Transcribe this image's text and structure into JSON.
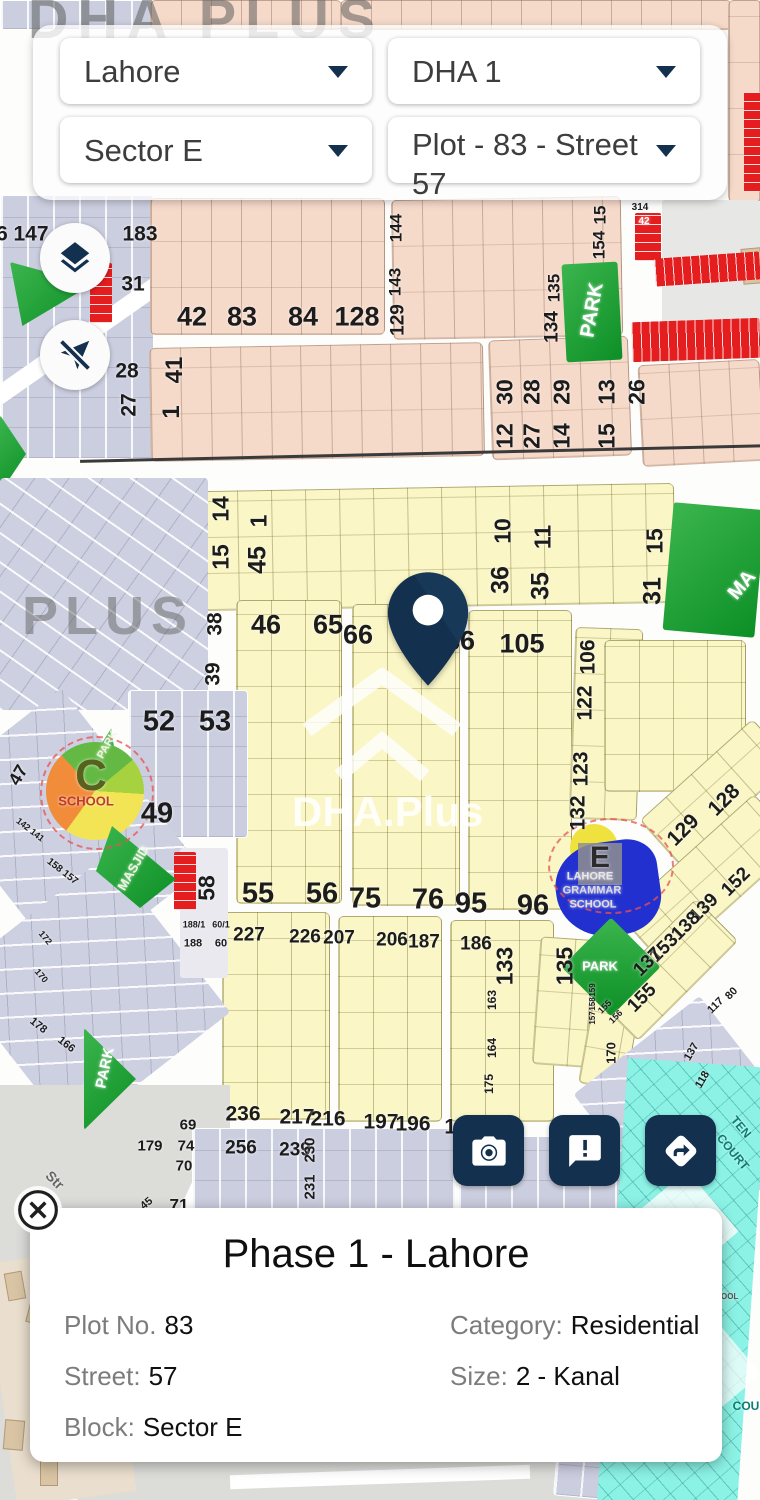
{
  "header": {
    "city": "Lahore",
    "phase": "DHA 1",
    "sector": "Sector E",
    "plot": "Plot - 83 - Street 57"
  },
  "icons": {
    "layers": "layers-icon",
    "location": "location-disabled-icon",
    "camera": "camera-icon",
    "feedback": "feedback-icon",
    "directions": "directions-icon",
    "close": "close-icon",
    "pin": "map-pin-icon"
  },
  "watermarks": {
    "top": "DHA PLUS",
    "left": "PLUS",
    "center": "DHA.Plus"
  },
  "info_card": {
    "title": "Phase 1 - Lahore",
    "fields": [
      {
        "label": "Plot No.",
        "value": "83"
      },
      {
        "label": "Category:",
        "value": "Residential"
      },
      {
        "label": "Street:",
        "value": "57"
      },
      {
        "label": "Size:",
        "value": "2 - Kanal"
      },
      {
        "label": "Block:",
        "value": "Sector E"
      }
    ]
  },
  "map": {
    "labels": [
      {
        "t": "6",
        "x": 2,
        "y": 234,
        "s": 21
      },
      {
        "t": "147",
        "x": 31,
        "y": 234,
        "s": 21
      },
      {
        "t": "183",
        "x": 140,
        "y": 234,
        "s": 21
      },
      {
        "t": "31",
        "x": 133,
        "y": 284,
        "s": 21
      },
      {
        "t": "28",
        "x": 127,
        "y": 371,
        "s": 21
      },
      {
        "t": "27",
        "x": 129,
        "y": 405,
        "s": 21,
        "r": -90
      },
      {
        "t": "42",
        "x": 192,
        "y": 317,
        "s": 27
      },
      {
        "t": "83",
        "x": 242,
        "y": 317,
        "s": 27
      },
      {
        "t": "84",
        "x": 303,
        "y": 317,
        "s": 27
      },
      {
        "t": "128",
        "x": 357,
        "y": 317,
        "s": 27
      },
      {
        "t": "41",
        "x": 175,
        "y": 370,
        "s": 24,
        "r": -90
      },
      {
        "t": "1",
        "x": 172,
        "y": 412,
        "s": 24,
        "r": -90
      },
      {
        "t": "144",
        "x": 396,
        "y": 228,
        "s": 17,
        "r": -90
      },
      {
        "t": "143",
        "x": 395,
        "y": 282,
        "s": 17,
        "r": -90
      },
      {
        "t": "129",
        "x": 398,
        "y": 320,
        "s": 19,
        "r": -90
      },
      {
        "t": "15",
        "x": 600,
        "y": 215,
        "s": 17,
        "r": -90
      },
      {
        "t": "154",
        "x": 599,
        "y": 245,
        "s": 17,
        "r": -90
      },
      {
        "t": "135",
        "x": 554,
        "y": 288,
        "s": 17,
        "r": -90
      },
      {
        "t": "134",
        "x": 552,
        "y": 327,
        "s": 19,
        "r": -90
      },
      {
        "t": "PARK",
        "x": 592,
        "y": 310,
        "s": 20,
        "r": -80,
        "c": "#ffffff"
      },
      {
        "t": "314",
        "x": 640,
        "y": 208,
        "s": 10
      },
      {
        "t": "42",
        "x": 644,
        "y": 222,
        "s": 10,
        "c": "#ffffff"
      },
      {
        "t": "30",
        "x": 505,
        "y": 392,
        "s": 23,
        "r": -90
      },
      {
        "t": "12",
        "x": 505,
        "y": 436,
        "s": 23,
        "r": -90
      },
      {
        "t": "28",
        "x": 532,
        "y": 392,
        "s": 23,
        "r": -90
      },
      {
        "t": "27",
        "x": 532,
        "y": 436,
        "s": 23,
        "r": -90
      },
      {
        "t": "29",
        "x": 562,
        "y": 392,
        "s": 23,
        "r": -90
      },
      {
        "t": "14",
        "x": 562,
        "y": 436,
        "s": 23,
        "r": -90
      },
      {
        "t": "13",
        "x": 607,
        "y": 392,
        "s": 23,
        "r": -90
      },
      {
        "t": "15",
        "x": 607,
        "y": 436,
        "s": 23,
        "r": -90
      },
      {
        "t": "26",
        "x": 637,
        "y": 392,
        "s": 23,
        "r": -90
      },
      {
        "t": "14",
        "x": 221,
        "y": 509,
        "s": 23,
        "r": -90
      },
      {
        "t": "15",
        "x": 221,
        "y": 557,
        "s": 23,
        "r": -90
      },
      {
        "t": "1",
        "x": 259,
        "y": 521,
        "s": 23,
        "r": -90
      },
      {
        "t": "45",
        "x": 258,
        "y": 560,
        "s": 25,
        "r": -90
      },
      {
        "t": "10",
        "x": 503,
        "y": 531,
        "s": 23,
        "r": -90
      },
      {
        "t": "36",
        "x": 501,
        "y": 580,
        "s": 25,
        "r": -90
      },
      {
        "t": "11",
        "x": 543,
        "y": 537,
        "s": 23,
        "r": -90
      },
      {
        "t": "35",
        "x": 541,
        "y": 586,
        "s": 25,
        "r": -90
      },
      {
        "t": "15",
        "x": 655,
        "y": 541,
        "s": 23,
        "r": -90
      },
      {
        "t": "31",
        "x": 653,
        "y": 591,
        "s": 25,
        "r": -90
      },
      {
        "t": "MA",
        "x": 742,
        "y": 585,
        "s": 20,
        "r": -50,
        "c": "#ffffff"
      },
      {
        "t": "46",
        "x": 266,
        "y": 625,
        "s": 27
      },
      {
        "t": "65",
        "x": 328,
        "y": 625,
        "s": 27
      },
      {
        "t": "66",
        "x": 358,
        "y": 635,
        "s": 27
      },
      {
        "t": "86",
        "x": 460,
        "y": 641,
        "s": 27
      },
      {
        "t": "105",
        "x": 522,
        "y": 644,
        "s": 27
      },
      {
        "t": "106",
        "x": 588,
        "y": 657,
        "s": 21,
        "r": -90
      },
      {
        "t": "122",
        "x": 585,
        "y": 703,
        "s": 21,
        "r": -90
      },
      {
        "t": "123",
        "x": 581,
        "y": 769,
        "s": 21,
        "r": -90
      },
      {
        "t": "132",
        "x": 578,
        "y": 813,
        "s": 21,
        "r": -90
      },
      {
        "t": "52",
        "x": 159,
        "y": 722,
        "s": 29
      },
      {
        "t": "53",
        "x": 215,
        "y": 722,
        "s": 29
      },
      {
        "t": "49",
        "x": 157,
        "y": 814,
        "s": 29
      },
      {
        "t": "C",
        "x": 91,
        "y": 776,
        "s": 44,
        "c": "#56621d"
      },
      {
        "t": "SCHOOL",
        "x": 86,
        "y": 801,
        "s": 13,
        "c": "#c0392b"
      },
      {
        "t": "PARK",
        "x": 108,
        "y": 745,
        "s": 11,
        "r": -60,
        "c": "#eef7e0"
      },
      {
        "t": "MASJID",
        "x": 133,
        "y": 868,
        "s": 13,
        "r": -60,
        "c": "#eef7e0"
      },
      {
        "t": "58",
        "x": 207,
        "y": 888,
        "s": 23,
        "r": -90
      },
      {
        "t": "47",
        "x": 18,
        "y": 775,
        "s": 18,
        "r": -60
      },
      {
        "t": "38",
        "x": 215,
        "y": 624,
        "s": 21,
        "r": -90
      },
      {
        "t": "39",
        "x": 213,
        "y": 674,
        "s": 21,
        "r": -90
      },
      {
        "t": "142 141",
        "x": 30,
        "y": 830,
        "s": 9,
        "r": 38
      },
      {
        "t": "158 157",
        "x": 62,
        "y": 872,
        "s": 10,
        "r": 38
      },
      {
        "t": "172",
        "x": 45,
        "y": 938,
        "s": 9,
        "r": 50
      },
      {
        "t": "170",
        "x": 41,
        "y": 976,
        "s": 9,
        "r": 50
      },
      {
        "t": "55",
        "x": 258,
        "y": 894,
        "s": 29
      },
      {
        "t": "56",
        "x": 322,
        "y": 894,
        "s": 29
      },
      {
        "t": "75",
        "x": 365,
        "y": 899,
        "s": 29
      },
      {
        "t": "76",
        "x": 428,
        "y": 900,
        "s": 29
      },
      {
        "t": "95",
        "x": 471,
        "y": 904,
        "s": 29
      },
      {
        "t": "96",
        "x": 533,
        "y": 906,
        "s": 29
      },
      {
        "t": "227",
        "x": 249,
        "y": 935,
        "s": 19
      },
      {
        "t": "226",
        "x": 305,
        "y": 937,
        "s": 19
      },
      {
        "t": "207",
        "x": 339,
        "y": 938,
        "s": 19
      },
      {
        "t": "206",
        "x": 392,
        "y": 940,
        "s": 19
      },
      {
        "t": "187",
        "x": 424,
        "y": 942,
        "s": 19
      },
      {
        "t": "186",
        "x": 476,
        "y": 944,
        "s": 19
      },
      {
        "t": "188/1",
        "x": 194,
        "y": 925,
        "s": 9
      },
      {
        "t": "60/1",
        "x": 221,
        "y": 925,
        "s": 9
      },
      {
        "t": "188",
        "x": 193,
        "y": 944,
        "s": 11
      },
      {
        "t": "60",
        "x": 221,
        "y": 944,
        "s": 11
      },
      {
        "t": "133",
        "x": 505,
        "y": 966,
        "s": 23,
        "r": -90
      },
      {
        "t": "135",
        "x": 565,
        "y": 966,
        "s": 23,
        "r": -90
      },
      {
        "t": "163",
        "x": 492,
        "y": 1000,
        "s": 12,
        "r": -90
      },
      {
        "t": "164",
        "x": 492,
        "y": 1048,
        "s": 12,
        "r": -90
      },
      {
        "t": "175",
        "x": 489,
        "y": 1084,
        "s": 12,
        "r": -90
      },
      {
        "t": "159",
        "x": 593,
        "y": 990,
        "s": 8,
        "r": -90
      },
      {
        "t": "158",
        "x": 593,
        "y": 1004,
        "s": 8,
        "r": -90
      },
      {
        "t": "157",
        "x": 593,
        "y": 1018,
        "s": 8,
        "r": -90
      },
      {
        "t": "170",
        "x": 611,
        "y": 1053,
        "s": 13,
        "r": -90
      },
      {
        "t": "155",
        "x": 605,
        "y": 1007,
        "s": 9,
        "r": -45
      },
      {
        "t": "156",
        "x": 616,
        "y": 1017,
        "s": 9,
        "r": -45
      },
      {
        "t": "PARK",
        "x": 600,
        "y": 966,
        "s": 13,
        "c": "#ffffff"
      },
      {
        "t": "128",
        "x": 724,
        "y": 800,
        "s": 21,
        "r": -45
      },
      {
        "t": "129",
        "x": 683,
        "y": 830,
        "s": 21,
        "r": -45
      },
      {
        "t": "152",
        "x": 736,
        "y": 882,
        "s": 19,
        "r": -45
      },
      {
        "t": "139",
        "x": 704,
        "y": 908,
        "s": 19,
        "r": -45
      },
      {
        "t": "138",
        "x": 686,
        "y": 926,
        "s": 19,
        "r": -45
      },
      {
        "t": "153",
        "x": 664,
        "y": 948,
        "s": 19,
        "r": -45
      },
      {
        "t": "137",
        "x": 648,
        "y": 962,
        "s": 19,
        "r": -45
      },
      {
        "t": "155",
        "x": 642,
        "y": 998,
        "s": 19,
        "r": -45
      },
      {
        "t": "E",
        "x": 600,
        "y": 858,
        "s": 30,
        "c": "#2b2b2b"
      },
      {
        "t": "LAHORE",
        "x": 590,
        "y": 877,
        "s": 11,
        "c": "#e8e8e8"
      },
      {
        "t": "GRAMMAR",
        "x": 592,
        "y": 891,
        "s": 11,
        "c": "#dcdcdc"
      },
      {
        "t": "SCHOOL",
        "x": 593,
        "y": 905,
        "s": 11,
        "c": "#e0e0e0"
      },
      {
        "t": "117",
        "x": 716,
        "y": 1006,
        "s": 11,
        "r": -45
      },
      {
        "t": "80",
        "x": 732,
        "y": 994,
        "s": 11,
        "r": -45
      },
      {
        "t": "137",
        "x": 692,
        "y": 1052,
        "s": 11,
        "r": -60
      },
      {
        "t": "118",
        "x": 703,
        "y": 1080,
        "s": 11,
        "r": -60
      },
      {
        "t": "236",
        "x": 243,
        "y": 1114,
        "s": 21
      },
      {
        "t": "217",
        "x": 297,
        "y": 1117,
        "s": 21
      },
      {
        "t": "216",
        "x": 328,
        "y": 1119,
        "s": 21
      },
      {
        "t": "197",
        "x": 381,
        "y": 1122,
        "s": 21
      },
      {
        "t": "196",
        "x": 413,
        "y": 1124,
        "s": 21
      },
      {
        "t": "17",
        "x": 456,
        "y": 1127,
        "s": 21
      },
      {
        "t": "256",
        "x": 241,
        "y": 1148,
        "s": 19
      },
      {
        "t": "239",
        "x": 295,
        "y": 1150,
        "s": 19
      },
      {
        "t": "230",
        "x": 310,
        "y": 1150,
        "s": 15,
        "r": -90
      },
      {
        "t": "231",
        "x": 310,
        "y": 1187,
        "s": 15,
        "r": -90
      },
      {
        "t": "69",
        "x": 188,
        "y": 1125,
        "s": 15
      },
      {
        "t": "179",
        "x": 150,
        "y": 1146,
        "s": 15
      },
      {
        "t": "74",
        "x": 186,
        "y": 1146,
        "s": 15
      },
      {
        "t": "70",
        "x": 184,
        "y": 1166,
        "s": 15
      },
      {
        "t": "71",
        "x": 179,
        "y": 1205,
        "s": 17
      },
      {
        "t": "45",
        "x": 147,
        "y": 1204,
        "s": 11,
        "r": -40
      },
      {
        "t": "PARK",
        "x": 105,
        "y": 1068,
        "s": 15,
        "r": -78,
        "c": "#ffffff"
      },
      {
        "t": "178",
        "x": 38,
        "y": 1026,
        "s": 11,
        "r": 38
      },
      {
        "t": "166",
        "x": 66,
        "y": 1045,
        "s": 11,
        "r": 38
      },
      {
        "t": "Str",
        "x": 55,
        "y": 1180,
        "s": 14,
        "r": 45,
        "c": "#666666"
      },
      {
        "t": "TEN",
        "x": 741,
        "y": 1127,
        "s": 12,
        "r": 50,
        "c": "#0c7d72"
      },
      {
        "t": "COURT",
        "x": 733,
        "y": 1152,
        "s": 12,
        "r": 50,
        "c": "#0c7d72"
      },
      {
        "t": "POOL",
        "x": 727,
        "y": 1297,
        "s": 8,
        "c": "#555555"
      },
      {
        "t": "COU",
        "x": 746,
        "y": 1406,
        "s": 12,
        "c": "#0c7d72"
      }
    ]
  }
}
